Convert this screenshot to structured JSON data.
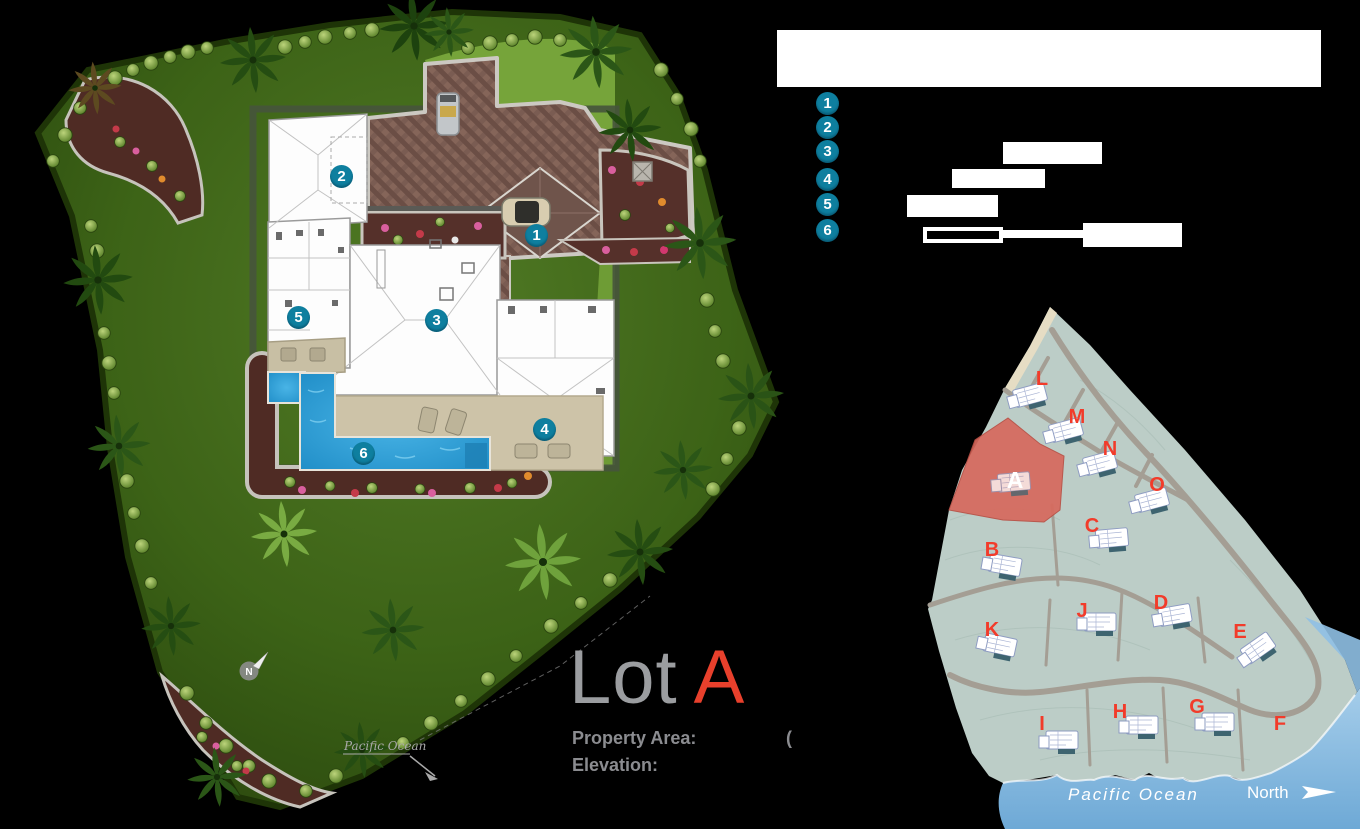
{
  "canvas": {
    "background": "#000000"
  },
  "site_plan": {
    "compass_label": "N",
    "ocean_label": "Pacific Ocean",
    "markers": [
      {
        "number": "1"
      },
      {
        "number": "2"
      },
      {
        "number": "3"
      },
      {
        "number": "4"
      },
      {
        "number": "5"
      },
      {
        "number": "6"
      }
    ]
  },
  "legend": {
    "badge_color": "#0e7f9f",
    "items": [
      {
        "number": "1"
      },
      {
        "number": "2"
      },
      {
        "number": "3"
      },
      {
        "number": "4"
      },
      {
        "number": "5"
      },
      {
        "number": "6"
      }
    ]
  },
  "title": {
    "lot_prefix": "Lot",
    "lot_letter": "A",
    "lot_letter_color": "#e8402c",
    "property_area_label": "Property Area:",
    "property_area_paren": "(",
    "elevation_label": "Elevation:"
  },
  "map": {
    "land_color": "#bccdc7",
    "water_color": "#8fc0e4",
    "highlight_color": "#d7695d",
    "letter_color": "#f23b2a",
    "ocean_label": "Pacific Ocean",
    "north_label": "North",
    "highlighted_lot": "A",
    "lots": [
      {
        "label": "L"
      },
      {
        "label": "M"
      },
      {
        "label": "N"
      },
      {
        "label": "O"
      },
      {
        "label": "A",
        "highlighted": true
      },
      {
        "label": "B"
      },
      {
        "label": "C"
      },
      {
        "label": "K"
      },
      {
        "label": "J"
      },
      {
        "label": "D"
      },
      {
        "label": "E"
      },
      {
        "label": "I"
      },
      {
        "label": "H"
      },
      {
        "label": "G"
      },
      {
        "label": "F"
      }
    ]
  }
}
